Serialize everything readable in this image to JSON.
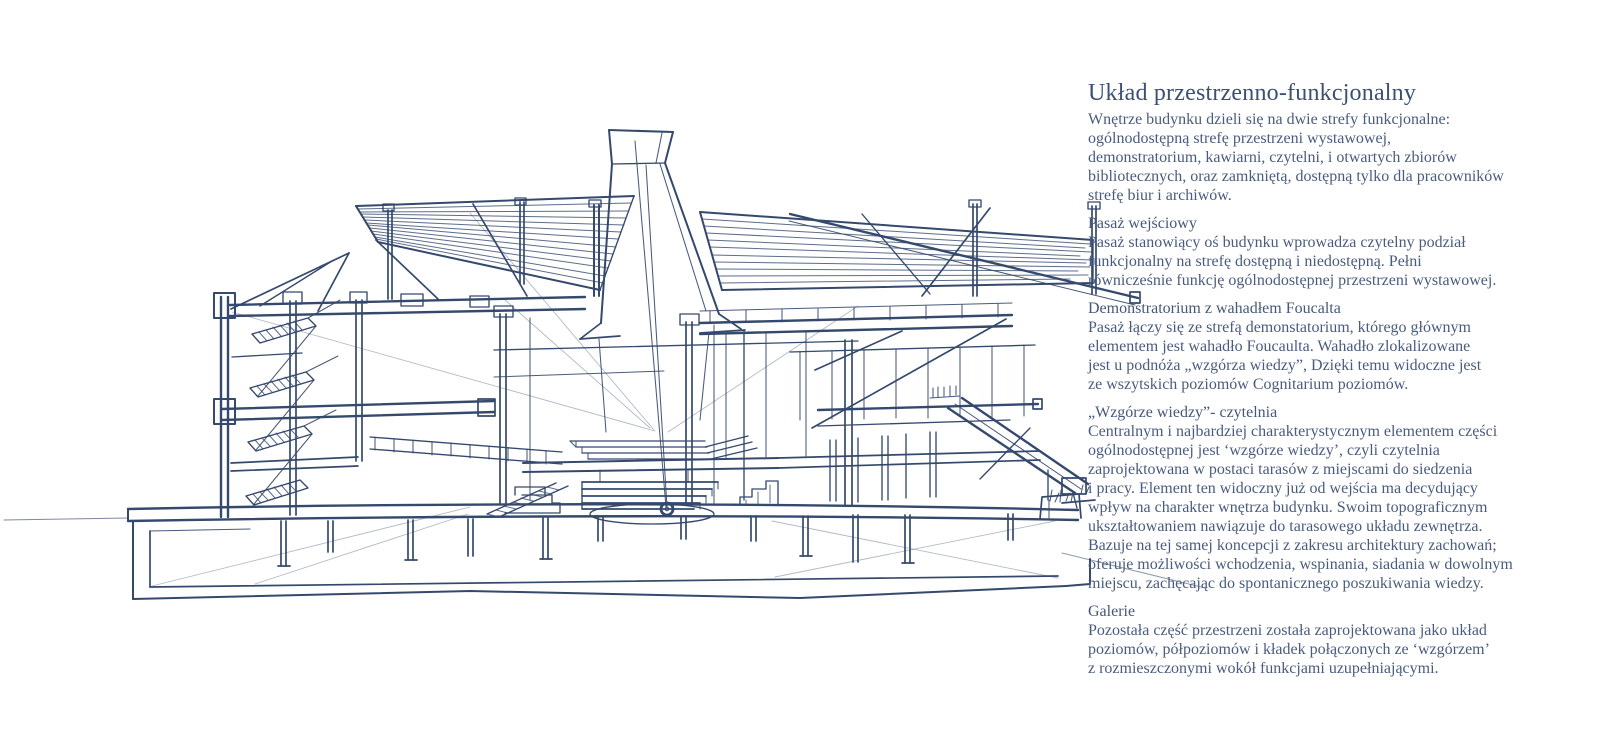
{
  "page": {
    "background_color": "#ffffff"
  },
  "sketch": {
    "kind": "hand-drawn architectural cross-section sketch",
    "ink_color": "#35496d",
    "elements": [
      "roof-canopy-left",
      "roof-canopy-right",
      "central-tower",
      "foucault-pendulum",
      "terraced-steps",
      "stair-tower",
      "galleries",
      "ramp",
      "basement",
      "pilotis",
      "grass"
    ]
  },
  "article": {
    "title": "Układ przestrzenno-funkcjonalny",
    "sections": [
      {
        "heading": "",
        "body": "Wnętrze budynku dzieli się na dwie strefy funkcjonalne:\nogólnodostępną strefę przestrzeni wystawowej,\ndemonstratorium, kawiarni, czytelni, i otwartych zbiorów\nbibliotecznych, oraz zamkniętą, dostępną tylko dla pracowników\nstrefę biur i archiwów."
      },
      {
        "heading": "Pasaż wejściowy",
        "body": "Pasaż stanowiący oś budynku wprowadza czytelny podział\nfunkcjonalny na strefę dostępną i niedostępną. Pełni\nrównicześnie funkcję ogólnodostępnej przestrzeni wystawowej."
      },
      {
        "heading": "Demonstratorium z wahadłem Foucalta",
        "body": "Pasaż łączy się ze strefą demonstatorium, którego głównym\nelementem jest wahadło Foucaulta. Wahadło zlokalizowane\njest u podnóża „wzgórza wiedzy”, Dzięki temu widoczne jest\nze wszytskich poziomów Cognitarium poziomów."
      },
      {
        "heading": "„Wzgórze wiedzy”- czytelnia",
        "body": "Centralnym i najbardziej charakterystycznym elementem części\nogólnodostępnej jest ‘wzgórze wiedzy’, czyli czytelnia\nzaprojektowana w postaci tarasów z miejscami do siedzenia\ni pracy. Element ten widoczny już od wejścia ma decydujący\nwpływ na charakter wnętrza budynku. Swoim topograficznym\nukształtowaniem nawiązuje do tarasowego układu zewnętrza.\nBazuje na tej samej koncepcji z zakresu architektury zachowań;\noferuje możliwości wchodzenia, wspinania, siadania w dowolnym\nmiejscu, zachęcając do spontanicznego poszukiwania wiedzy."
      },
      {
        "heading": "Galerie",
        "body": "Pozostała część przestrzeni została zaprojektowana jako układ\npoziomów, półpoziomów i kładek połączonych ze ‘wzgórzem’\nz rozmieszczonymi wokół funkcjami uzupełniającymi."
      }
    ]
  }
}
